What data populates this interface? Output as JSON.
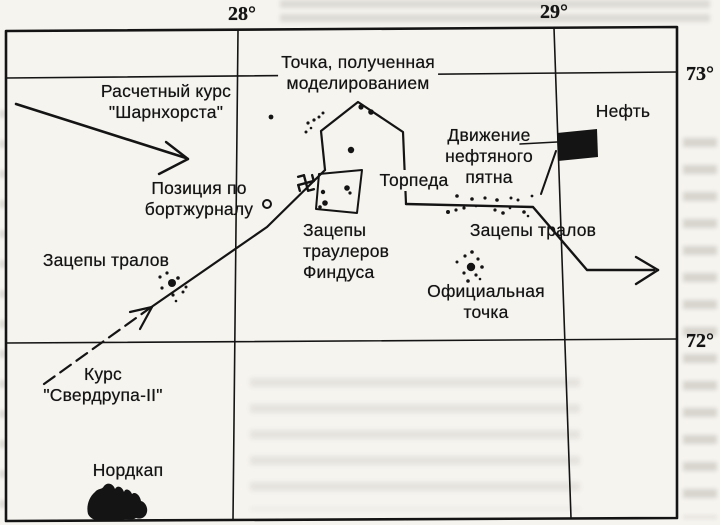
{
  "page": {
    "bg": "#f6f4ef",
    "ink": "#141414"
  },
  "map": {
    "grid_labels": [
      {
        "id": "lon-28",
        "text": "28°",
        "x": 242,
        "y": 3
      },
      {
        "id": "lon-29",
        "text": "29°",
        "x": 554,
        "y": 1
      },
      {
        "id": "lat-73",
        "text": "73°",
        "x": 700,
        "y": 63
      },
      {
        "id": "lat-72",
        "text": "72°",
        "x": 700,
        "y": 330
      }
    ],
    "annotations": [
      {
        "id": "model-point-label",
        "lines": [
          "Точка, полученная",
          "моделированием"
        ],
        "x": 358,
        "y": 52,
        "anchor": "center",
        "opaque": true
      },
      {
        "id": "calc-course-label",
        "lines": [
          "Расчетный курс",
          "\"Шарнхорста\""
        ],
        "x": 166,
        "y": 81,
        "anchor": "center",
        "opaque": true
      },
      {
        "id": "oil-label",
        "lines": [
          "Нефть"
        ],
        "x": 623,
        "y": 101,
        "anchor": "center",
        "opaque": true
      },
      {
        "id": "oil-drift-label",
        "lines": [
          "Движение",
          "нефтяного",
          "пятна"
        ],
        "x": 489,
        "y": 125,
        "anchor": "center",
        "opaque": false
      },
      {
        "id": "log-position-label",
        "lines": [
          "Позиция по",
          "бортжурналу"
        ],
        "x": 199,
        "y": 178,
        "anchor": "center",
        "opaque": false
      },
      {
        "id": "torpedo-label",
        "lines": [
          "Торпеда"
        ],
        "x": 414,
        "y": 170,
        "anchor": "center",
        "opaque": true
      },
      {
        "id": "trawl-snags-right-label",
        "lines": [
          "Зацепы тралов"
        ],
        "x": 533,
        "y": 220,
        "anchor": "center",
        "opaque": false
      },
      {
        "id": "findus-snags-label",
        "lines": [
          "Зацепы",
          "траулеров",
          "Финдуса"
        ],
        "x": 303,
        "y": 220,
        "anchor": "left",
        "opaque": false
      },
      {
        "id": "official-point-label",
        "lines": [
          "Официальная",
          "точка"
        ],
        "x": 486,
        "y": 281,
        "anchor": "center",
        "opaque": false
      },
      {
        "id": "sverdrup-course-label",
        "lines": [
          "Курс",
          "\"Свердрупа-II\""
        ],
        "x": 103,
        "y": 364,
        "anchor": "center",
        "opaque": false
      },
      {
        "id": "trawl-snags-left-label",
        "lines": [
          "Зацепы тралов"
        ],
        "x": 106,
        "y": 250,
        "anchor": "center",
        "opaque": false
      },
      {
        "id": "nordkap-label",
        "lines": [
          "Нордкап"
        ],
        "x": 128,
        "y": 460,
        "anchor": "center",
        "opaque": false
      }
    ],
    "geometry": {
      "frame": {
        "pts": [
          [
            6,
            31
          ],
          [
            677,
            27
          ],
          [
            677,
            518
          ],
          [
            6,
            521
          ]
        ],
        "w": 2.6
      },
      "gridlines": [
        {
          "id": "parallel-73",
          "pts": [
            [
              6,
              78
            ],
            [
              677,
              72
            ]
          ],
          "w": 1.6
        },
        {
          "id": "parallel-72",
          "pts": [
            [
              6,
              343
            ],
            [
              677,
              339
            ]
          ],
          "w": 1.6
        },
        {
          "id": "meridian-28",
          "pts": [
            [
              238,
              31
            ],
            [
              233,
              520
            ]
          ],
          "w": 1.6
        },
        {
          "id": "meridian-29",
          "pts": [
            [
              554,
              28
            ],
            [
              571,
              518
            ]
          ],
          "w": 1.6
        }
      ],
      "segments": [
        {
          "id": "scharnhorst-course-line",
          "pts": [
            [
              16,
              104
            ],
            [
              186,
              158
            ]
          ],
          "w": 2.6
        },
        {
          "id": "scharnhorst-arrowhead-a",
          "pts": [
            [
              166,
              142
            ],
            [
              188,
              159
            ]
          ],
          "w": 2.4
        },
        {
          "id": "scharnhorst-arrowhead-b",
          "pts": [
            [
              159,
              174
            ],
            [
              188,
              159
            ]
          ],
          "w": 2.4
        },
        {
          "id": "sverdrup-course-dashed",
          "pts": [
            [
              44,
              384
            ],
            [
              150,
              308
            ]
          ],
          "w": 2.2,
          "dash": "13 7"
        },
        {
          "id": "sverdrup-course-line",
          "pts": [
            [
              150,
              308
            ],
            [
              267,
              227
            ],
            [
              325,
              170
            ]
          ],
          "w": 2.2
        },
        {
          "id": "sverdrup-arrowhead-a",
          "pts": [
            [
              130,
              312
            ],
            [
              152,
              307
            ]
          ],
          "w": 2.2
        },
        {
          "id": "sverdrup-arrowhead-b",
          "pts": [
            [
              140,
              329
            ],
            [
              152,
              307
            ]
          ],
          "w": 2.2
        },
        {
          "id": "model-track-polygon",
          "pts": [
            [
              325,
              170
            ],
            [
              321,
              131
            ],
            [
              358,
              102
            ],
            [
              403,
              132
            ],
            [
              406,
              204
            ]
          ],
          "w": 2.2
        },
        {
          "id": "wreck-track-line",
          "pts": [
            [
              406,
              204
            ],
            [
              533,
              207
            ],
            [
              587,
              270
            ],
            [
              654,
              270
            ]
          ],
          "w": 2.4
        },
        {
          "id": "track-arrowhead-a",
          "pts": [
            [
              636,
              257
            ],
            [
              658,
              270
            ]
          ],
          "w": 2.4
        },
        {
          "id": "track-arrowhead-b",
          "pts": [
            [
              636,
              284
            ],
            [
              658,
              270
            ]
          ],
          "w": 2.4
        },
        {
          "id": "oil-pointer-line",
          "pts": [
            [
              520,
              144
            ],
            [
              557,
              142
            ]
          ],
          "w": 1.6
        },
        {
          "id": "oil-drift-line",
          "pts": [
            [
              556,
              151
            ],
            [
              541,
              194
            ]
          ],
          "w": 2.0
        }
      ],
      "outline_polygons": [
        {
          "id": "findus-snag-box",
          "pts": [
            [
              319,
              174
            ],
            [
              362,
              170
            ],
            [
              357,
              213
            ],
            [
              316,
              209
            ]
          ],
          "w": 2.0
        }
      ],
      "filled_polygons": [
        {
          "id": "oil-patch",
          "pts": [
            [
              557,
              133
            ],
            [
              597,
              129
            ],
            [
              598,
              157
            ],
            [
              558,
              161
            ]
          ]
        }
      ],
      "nordkap_path": "M88,514 C86,506 89,497 95,492 C98,488 102,490 104,486 C107,482 113,483 115,489 C117,485 122,486 124,492 C125,488 130,489 132,494 C135,491 140,495 141,501 C145,502 148,507 147,512 C146,517 141,520 136,518 C132,521 126,518 122,520 C117,522 111,519 106,520 C99,522 91,520 88,514 Z",
      "ring_marker": {
        "cx": 267,
        "cy": 204,
        "r": 4,
        "w": 2
      },
      "swastika": {
        "cx": 306,
        "cy": 183,
        "arm": 8,
        "hook": 6,
        "w": 2.4,
        "rot": -15
      },
      "dots": [
        [
          271,
          117,
          2.4
        ],
        [
          308,
          123,
          1.6
        ],
        [
          314,
          120,
          1.6
        ],
        [
          319,
          117,
          1.5
        ],
        [
          323,
          113,
          1.5
        ],
        [
          311,
          128,
          1.3
        ],
        [
          306,
          132,
          1.5
        ],
        [
          361,
          107,
          2.6
        ],
        [
          371,
          112,
          2.8
        ],
        [
          351,
          150,
          3.2
        ],
        [
          347,
          188,
          2.8
        ],
        [
          350,
          193,
          1.6
        ],
        [
          323,
          192,
          2.2
        ],
        [
          325,
          203,
          2.8
        ],
        [
          320,
          207,
          1.8
        ],
        [
          457,
          196,
          1.8
        ],
        [
          472,
          199,
          1.8
        ],
        [
          485,
          198,
          1.6
        ],
        [
          497,
          200,
          1.8
        ],
        [
          511,
          198,
          1.5
        ],
        [
          518,
          200,
          1.5
        ],
        [
          532,
          196,
          1.4
        ],
        [
          448,
          212,
          2.0
        ],
        [
          456,
          210,
          1.6
        ],
        [
          464,
          208,
          1.6
        ],
        [
          476,
          206,
          1.3
        ],
        [
          495,
          210,
          1.6
        ],
        [
          503,
          213,
          1.8
        ],
        [
          510,
          208,
          1.3
        ],
        [
          524,
          212,
          1.8
        ],
        [
          528,
          216,
          1.3
        ],
        [
          471,
          267,
          4.2
        ],
        [
          465,
          256,
          1.6
        ],
        [
          472,
          252,
          1.8
        ],
        [
          478,
          259,
          1.6
        ],
        [
          482,
          267,
          1.8
        ],
        [
          476,
          275,
          1.6
        ],
        [
          464,
          273,
          1.6
        ],
        [
          457,
          262,
          1.5
        ],
        [
          468,
          281,
          1.8
        ],
        [
          480,
          279,
          1.3
        ],
        [
          172,
          283,
          4.0
        ],
        [
          160,
          277,
          1.6
        ],
        [
          167,
          273,
          1.6
        ],
        [
          178,
          278,
          1.8
        ],
        [
          186,
          287,
          1.5
        ],
        [
          162,
          288,
          1.6
        ],
        [
          173,
          295,
          1.6
        ],
        [
          183,
          292,
          1.5
        ],
        [
          176,
          301,
          1.3
        ]
      ]
    }
  }
}
